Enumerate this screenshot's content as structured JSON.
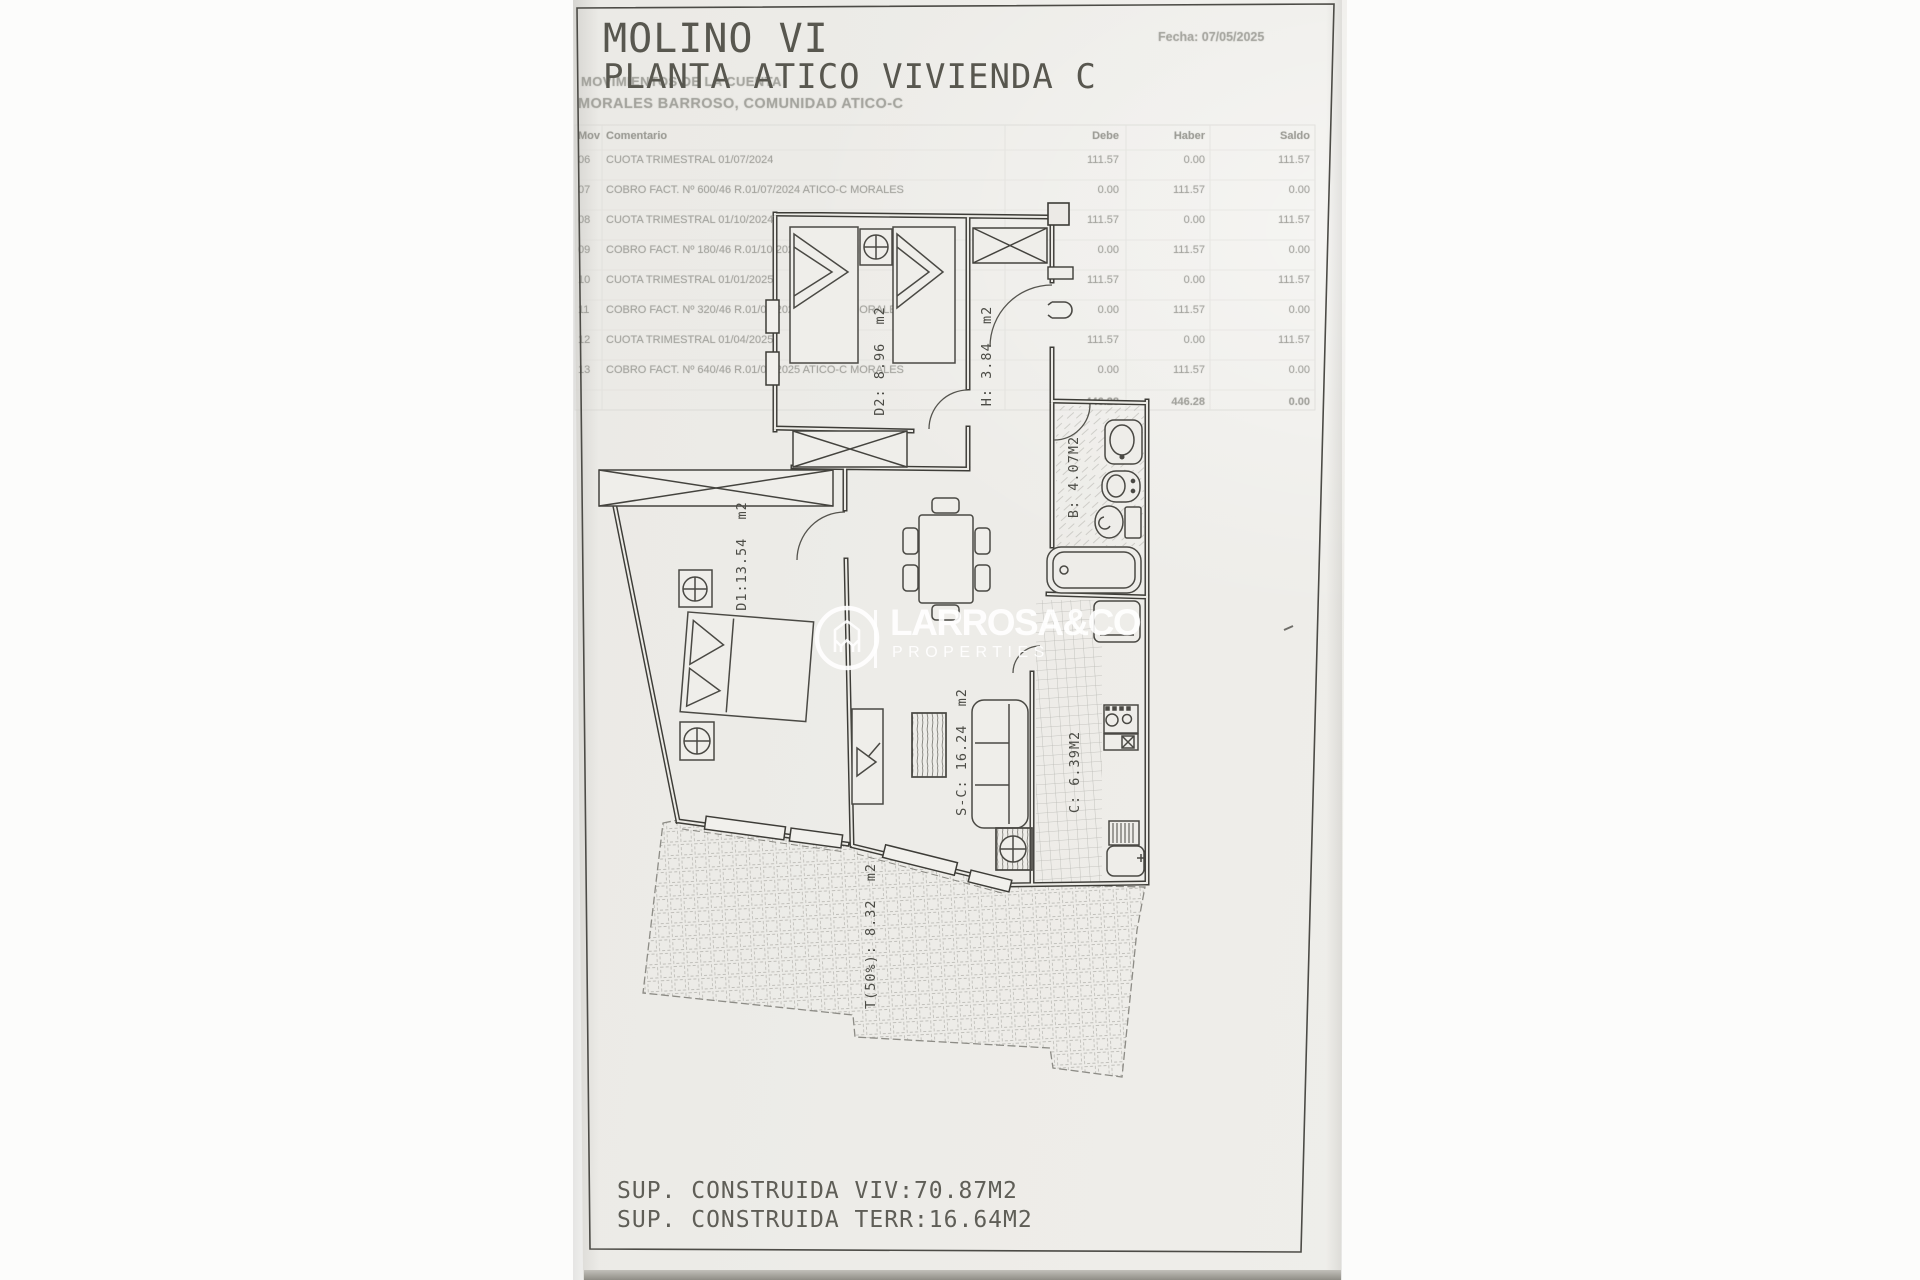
{
  "document": {
    "title_line1": "MOLINO VI",
    "title_line2": "PLANTA ATICO VIVIENDA C",
    "footer_line1": "SUP. CONSTRUIDA VIV:70.87M2",
    "footer_line2": "SUP. CONSTRUIDA TERR:16.64M2"
  },
  "floor_plan": {
    "rooms": [
      {
        "id": "D2",
        "label": "D2: 8.96  m2"
      },
      {
        "id": "H",
        "label": "H: 3.84  m2"
      },
      {
        "id": "B",
        "label": "B: 4.07M2"
      },
      {
        "id": "D1",
        "label": "D1:13.54  m2"
      },
      {
        "id": "S-C",
        "label": "S-C: 16.24  m2"
      },
      {
        "id": "C",
        "label": "C: 6.39M2"
      },
      {
        "id": "T",
        "label": "T(50%): 8.32  m2"
      }
    ]
  },
  "watermark": {
    "brand": "LARROSA&CO",
    "tagline": "PROPERTIES"
  },
  "bleed_through": {
    "top_line": "MOVIMIENTOS DE LA CUENTA",
    "account_line": "MORALES BARROSO, COMUNIDAD ATICO-C",
    "fecha": "Fecha: 07/05/2025",
    "headers": {
      "mov": "Mov",
      "comentario": "Comentario",
      "debe": "Debe",
      "haber": "Haber",
      "saldo": "Saldo"
    },
    "rows": [
      {
        "id": "06",
        "comentario": "CUOTA TRIMESTRAL 01/07/2024",
        "debe": "111.57",
        "haber": "0.00",
        "saldo": "111.57"
      },
      {
        "id": "07",
        "comentario": "COBRO FACT. Nº 600/46 R.01/07/2024 ATICO-C MORALES",
        "debe": "0.00",
        "haber": "111.57",
        "saldo": "0.00"
      },
      {
        "id": "08",
        "comentario": "CUOTA TRIMESTRAL 01/10/2024",
        "debe": "111.57",
        "haber": "0.00",
        "saldo": "111.57"
      },
      {
        "id": "09",
        "comentario": "COBRO FACT. Nº 180/46 R.01/10/2024 ATICO-C MORALES",
        "debe": "0.00",
        "haber": "111.57",
        "saldo": "0.00"
      },
      {
        "id": "10",
        "comentario": "CUOTA TRIMESTRAL 01/01/2025",
        "debe": "111.57",
        "haber": "0.00",
        "saldo": "111.57"
      },
      {
        "id": "11",
        "comentario": "COBRO FACT. Nº 320/46 R.01/01/2025 ATICO-C MORALES",
        "debe": "0.00",
        "haber": "111.57",
        "saldo": "0.00"
      },
      {
        "id": "12",
        "comentario": "CUOTA TRIMESTRAL 01/04/2025",
        "debe": "111.57",
        "haber": "0.00",
        "saldo": "111.57"
      },
      {
        "id": "13",
        "comentario": "COBRO FACT. Nº 640/46 R.01/04/2025 ATICO-C MORALES",
        "debe": "0.00",
        "haber": "111.57",
        "saldo": "0.00"
      }
    ],
    "totals": {
      "debe": "446.28",
      "haber": "446.28",
      "saldo": "0.00"
    }
  }
}
